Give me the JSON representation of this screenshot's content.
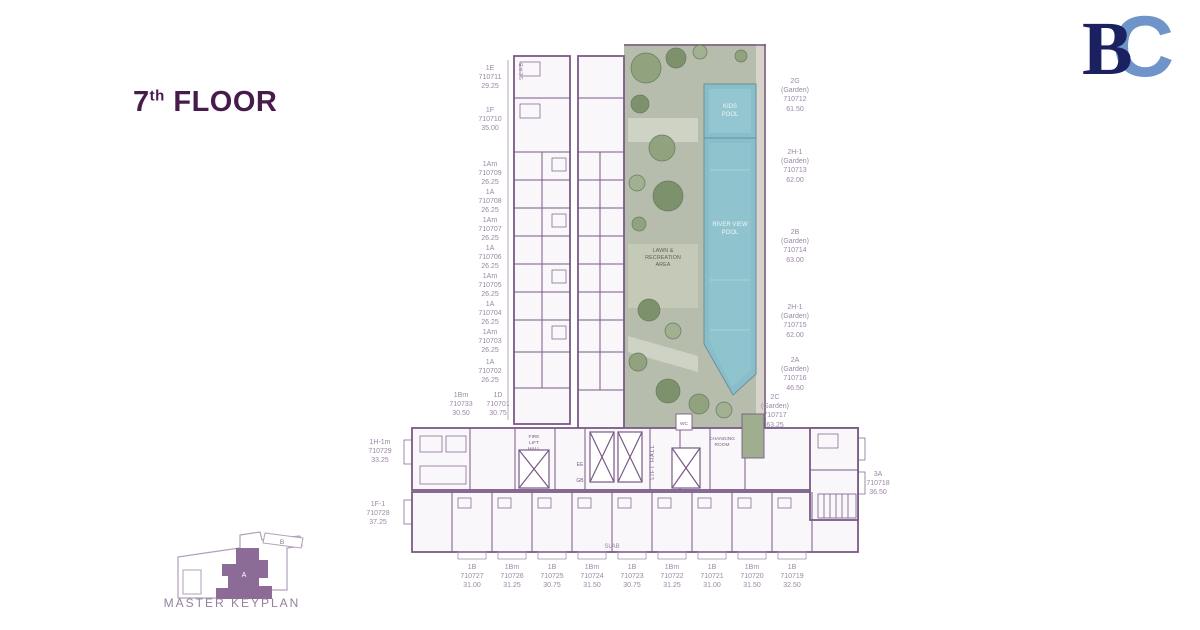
{
  "title": {
    "number": "7",
    "ordinal": "th",
    "word": "FLOOR"
  },
  "logo": {
    "b": "B",
    "c": "C"
  },
  "keyplan": {
    "label": "MASTER KEYPLAN",
    "building_a": "A",
    "building_b": "B"
  },
  "colors": {
    "title_text": "#471b4b",
    "wall": "#7a5a86",
    "unit_label": "#9b87a6",
    "garden": "#b6bdac",
    "tree": "#7b8f6a",
    "pool": "#88bec9",
    "keyplan_fill": "#8c6b96",
    "logo_b": "#1b2160",
    "logo_c": "#6f94c9"
  },
  "plan": {
    "left_units": [
      {
        "type": "1E",
        "no": "710711",
        "area": "29.25"
      },
      {
        "type": "1F",
        "no": "710710",
        "area": "35.00"
      },
      {
        "type": "1Am",
        "no": "710709",
        "area": "26.25"
      },
      {
        "type": "1A",
        "no": "710708",
        "area": "26.25"
      },
      {
        "type": "1Am",
        "no": "710707",
        "area": "26.25"
      },
      {
        "type": "1A",
        "no": "710706",
        "area": "26.25"
      },
      {
        "type": "1Am",
        "no": "710705",
        "area": "26.25"
      },
      {
        "type": "1A",
        "no": "710704",
        "area": "26.25"
      },
      {
        "type": "1Am",
        "no": "710703",
        "area": "26.25"
      },
      {
        "type": "1A",
        "no": "710702",
        "area": "26.25"
      }
    ],
    "corner_units": [
      {
        "type": "1Bm",
        "no": "710733",
        "area": "30.50"
      },
      {
        "type": "1D",
        "no": "710701",
        "area": "30.75"
      }
    ],
    "west_units": [
      {
        "type": "1H-1m",
        "no": "710729",
        "area": "33.25"
      },
      {
        "type": "1F-1",
        "no": "710728",
        "area": "37.25"
      }
    ],
    "garden_units": [
      {
        "type": "2G",
        "garden": "(Garden)",
        "no": "710712",
        "area": "61.50"
      },
      {
        "type": "2H-1",
        "garden": "(Garden)",
        "no": "710713",
        "area": "62.00"
      },
      {
        "type": "2B",
        "garden": "(Garden)",
        "no": "710714",
        "area": "63.00"
      },
      {
        "type": "2H-1",
        "garden": "(Garden)",
        "no": "710715",
        "area": "62.00"
      },
      {
        "type": "2A",
        "garden": "(Garden)",
        "no": "710716",
        "area": "46.50"
      },
      {
        "type": "2C",
        "garden": "(Garden)",
        "no": "710717",
        "area": "63.25"
      }
    ],
    "unit_3a": {
      "type": "3A",
      "no": "710718",
      "area": "36.50"
    },
    "bottom_units": [
      {
        "type": "1B",
        "no": "710727",
        "area": "31.00"
      },
      {
        "type": "1Bm",
        "no": "710726",
        "area": "31.25"
      },
      {
        "type": "1B",
        "no": "710725",
        "area": "30.75"
      },
      {
        "type": "1Bm",
        "no": "710724",
        "area": "31.50"
      },
      {
        "type": "1B",
        "no": "710723",
        "area": "30.75"
      },
      {
        "type": "1Bm",
        "no": "710722",
        "area": "31.25"
      },
      {
        "type": "1B",
        "no": "710721",
        "area": "31.00"
      },
      {
        "type": "1Bm",
        "no": "710720",
        "area": "31.50"
      },
      {
        "type": "1B",
        "no": "710719",
        "area": "32.50"
      }
    ],
    "amenities": {
      "kids": [
        "KIDS",
        "POOL"
      ],
      "river": [
        "RIVER VIEW",
        "POOL"
      ],
      "lawn": [
        "LAWN &",
        "RECREATION",
        "AREA"
      ]
    },
    "core": {
      "slab_top": "SLAB",
      "slab_bottom": "SLAB",
      "fire_lift": [
        "FIRE",
        "LIFT",
        "HALL"
      ],
      "lift_hall": "LIFT HALL",
      "ee": "EE",
      "gb": "GB",
      "wc": "WC",
      "changing": [
        "CHANGING",
        "ROOM"
      ]
    }
  }
}
